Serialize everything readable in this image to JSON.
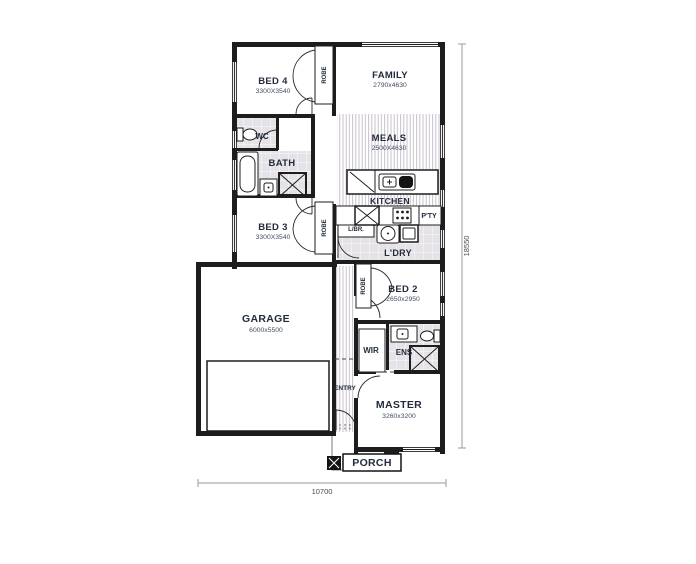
{
  "plan": {
    "rooms": {
      "bed4": {
        "label": "BED 4",
        "size": "3300X3540"
      },
      "family": {
        "label": "FAMILY",
        "size": "2790x4630"
      },
      "meals": {
        "label": "MEALS",
        "size": "2500X4630"
      },
      "kitchen": {
        "label": "KITCHEN"
      },
      "pantry": {
        "label": "P'TY"
      },
      "wc": {
        "label": "WC"
      },
      "bath": {
        "label": "BATH"
      },
      "bed3": {
        "label": "BED 3",
        "size": "3300X3540"
      },
      "linen": {
        "label": "L/BR."
      },
      "laundry": {
        "label": "L'DRY"
      },
      "bed2": {
        "label": "BED 2",
        "size": "2650x2950"
      },
      "garage": {
        "label": "GARAGE",
        "size": "6000x5500"
      },
      "entry": {
        "label": "ENTRY"
      },
      "wir": {
        "label": "WIR"
      },
      "ens": {
        "label": "ENS"
      },
      "master": {
        "label": "MASTER",
        "size": "3260x3200"
      },
      "porch": {
        "label": "PORCH"
      },
      "robe": {
        "label": "ROBE"
      }
    },
    "dimensions": {
      "width": "10700",
      "height": "18550"
    },
    "colors": {
      "wall": "#1d1d1d",
      "label": "#222b3d",
      "tile": "#e6e3e8",
      "stripe": "#c3b9c6",
      "dim_line": "#97999d"
    }
  }
}
